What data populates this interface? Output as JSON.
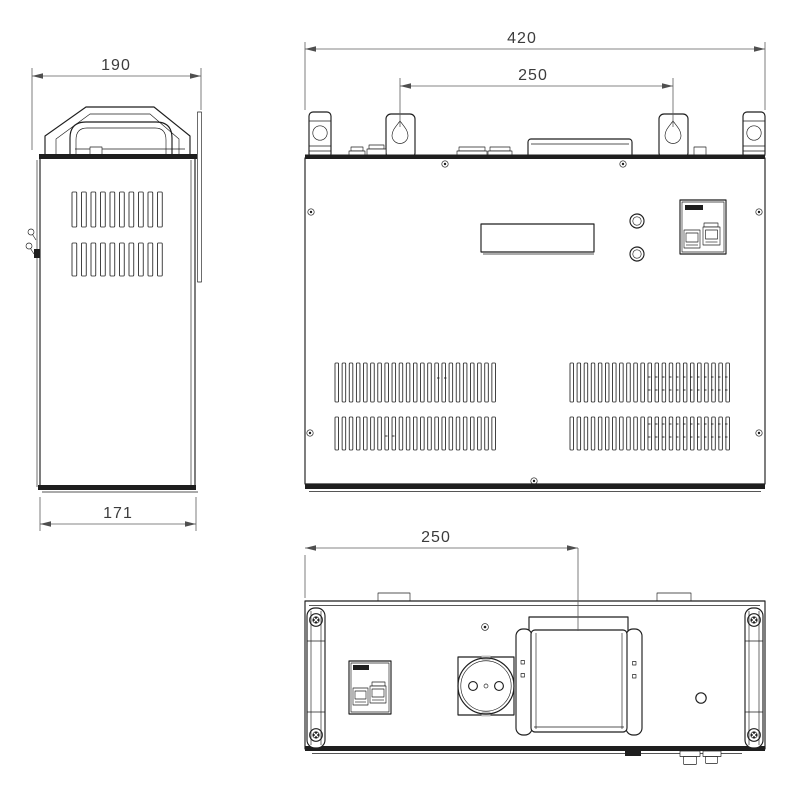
{
  "drawing": {
    "background": "#ffffff",
    "line_color": "#1e1e1e",
    "dimension_line_color": "#5c5c5c",
    "dimension_text_color": "#3c3c3c",
    "views": {
      "side_view": {
        "dimensions": {
          "depth_overall": "190",
          "depth_body": "171"
        }
      },
      "front_view": {
        "dimensions": {
          "overall_width": "420",
          "mounting_span": "250"
        }
      },
      "bottom_view": {
        "dimensions": {
          "terminal_offset": "250"
        }
      }
    }
  }
}
